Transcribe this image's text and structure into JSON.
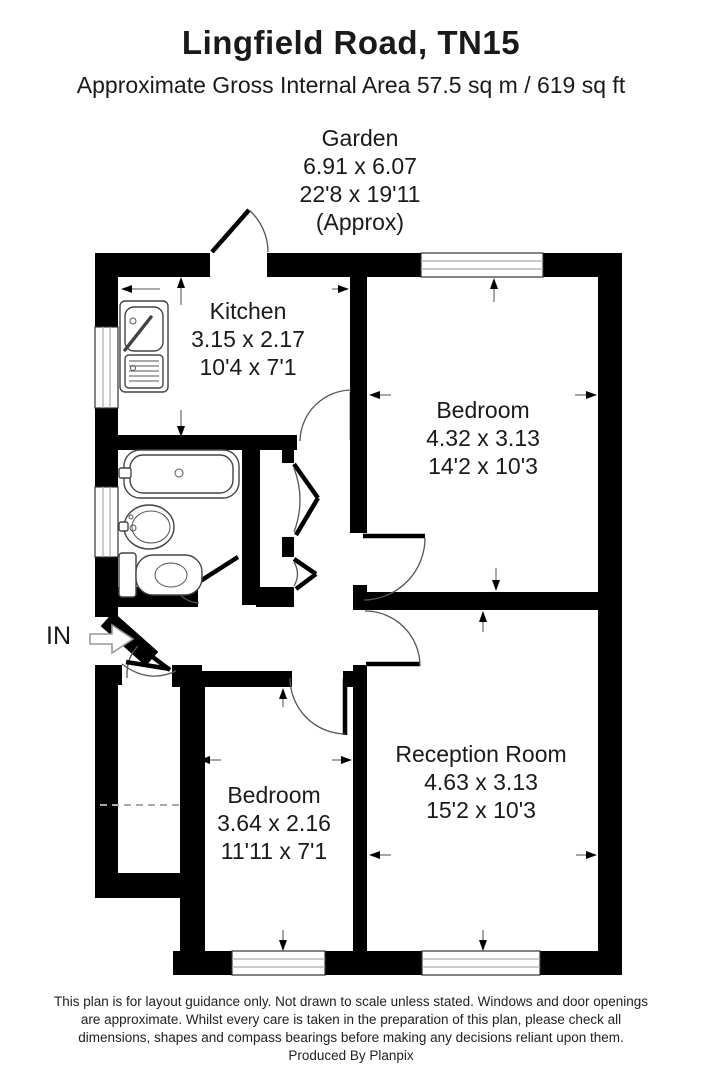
{
  "header": {
    "title": "Lingfield Road, TN15",
    "subtitle": "Approximate Gross Internal Area 57.5 sq m / 619 sq ft"
  },
  "garden": {
    "name": "Garden",
    "metric": "6.91 x 6.07",
    "imperial": "22'8 x 19'11",
    "approx": "(Approx)"
  },
  "rooms": {
    "kitchen": {
      "name": "Kitchen",
      "metric": "3.15 x 2.17",
      "imperial": "10'4 x 7'1"
    },
    "bedroom_top": {
      "name": "Bedroom",
      "metric": "4.32 x 3.13",
      "imperial": "14'2 x 10'3"
    },
    "reception": {
      "name": "Reception Room",
      "metric": "4.63 x 3.13",
      "imperial": "15'2 x 10'3"
    },
    "bedroom_bottom": {
      "name": "Bedroom",
      "metric": "3.64 x 2.16",
      "imperial": "11'11 x 7'1"
    }
  },
  "entry": {
    "label": "IN"
  },
  "footer": {
    "line1": "This plan is for layout guidance only. Not drawn to scale unless stated. Windows and door openings",
    "line2": "are approximate. Whilst every care is taken in the preparation of this plan, please check all",
    "line3": "dimensions, shapes and compass bearings before making any decisions reliant upon them.",
    "line4": "Produced By Planpix"
  },
  "colors": {
    "wall": "#000000",
    "background": "#ffffff",
    "window_line": "#aaaaaa"
  }
}
